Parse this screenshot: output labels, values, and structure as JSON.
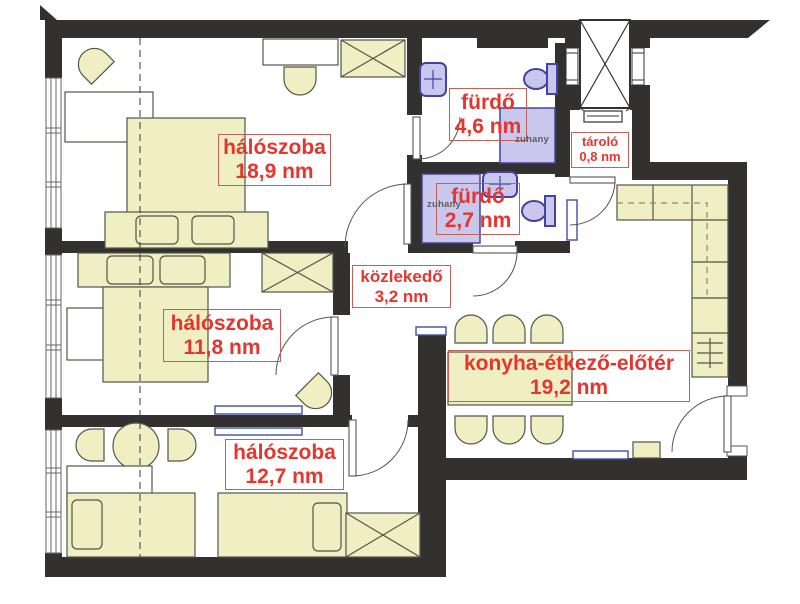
{
  "rooms": [
    {
      "id": "bedroom-1",
      "name": "hálószoba",
      "area": "18,9 nm"
    },
    {
      "id": "bathroom-1",
      "name": "fürdő",
      "area": "4,6 nm"
    },
    {
      "id": "storage",
      "name": "tároló",
      "area": "0,8 nm"
    },
    {
      "id": "bathroom-2",
      "name": "fürdő",
      "area": "2,7 nm"
    },
    {
      "id": "hallway",
      "name": "közlekedő",
      "area": "3,2 nm"
    },
    {
      "id": "bedroom-2",
      "name": "hálószoba",
      "area": "11,8 nm"
    },
    {
      "id": "kitchen",
      "name": "konyha-étkező-előtér",
      "area": "19,2 nm"
    },
    {
      "id": "bedroom-3",
      "name": "hálószoba",
      "area": "12,7 nm"
    }
  ],
  "fixture_labels": {
    "shower": "zuhany"
  },
  "colors": {
    "wall": "#333130",
    "furniture": "#efefc3",
    "furniture_stroke": "#55554a",
    "bath_fixture": "#c9c7ed",
    "bath_fixture_stroke": "#4343a0",
    "label_text": "#e4362e",
    "label_border": "#c2605a",
    "radiator": "#3c50aa"
  }
}
